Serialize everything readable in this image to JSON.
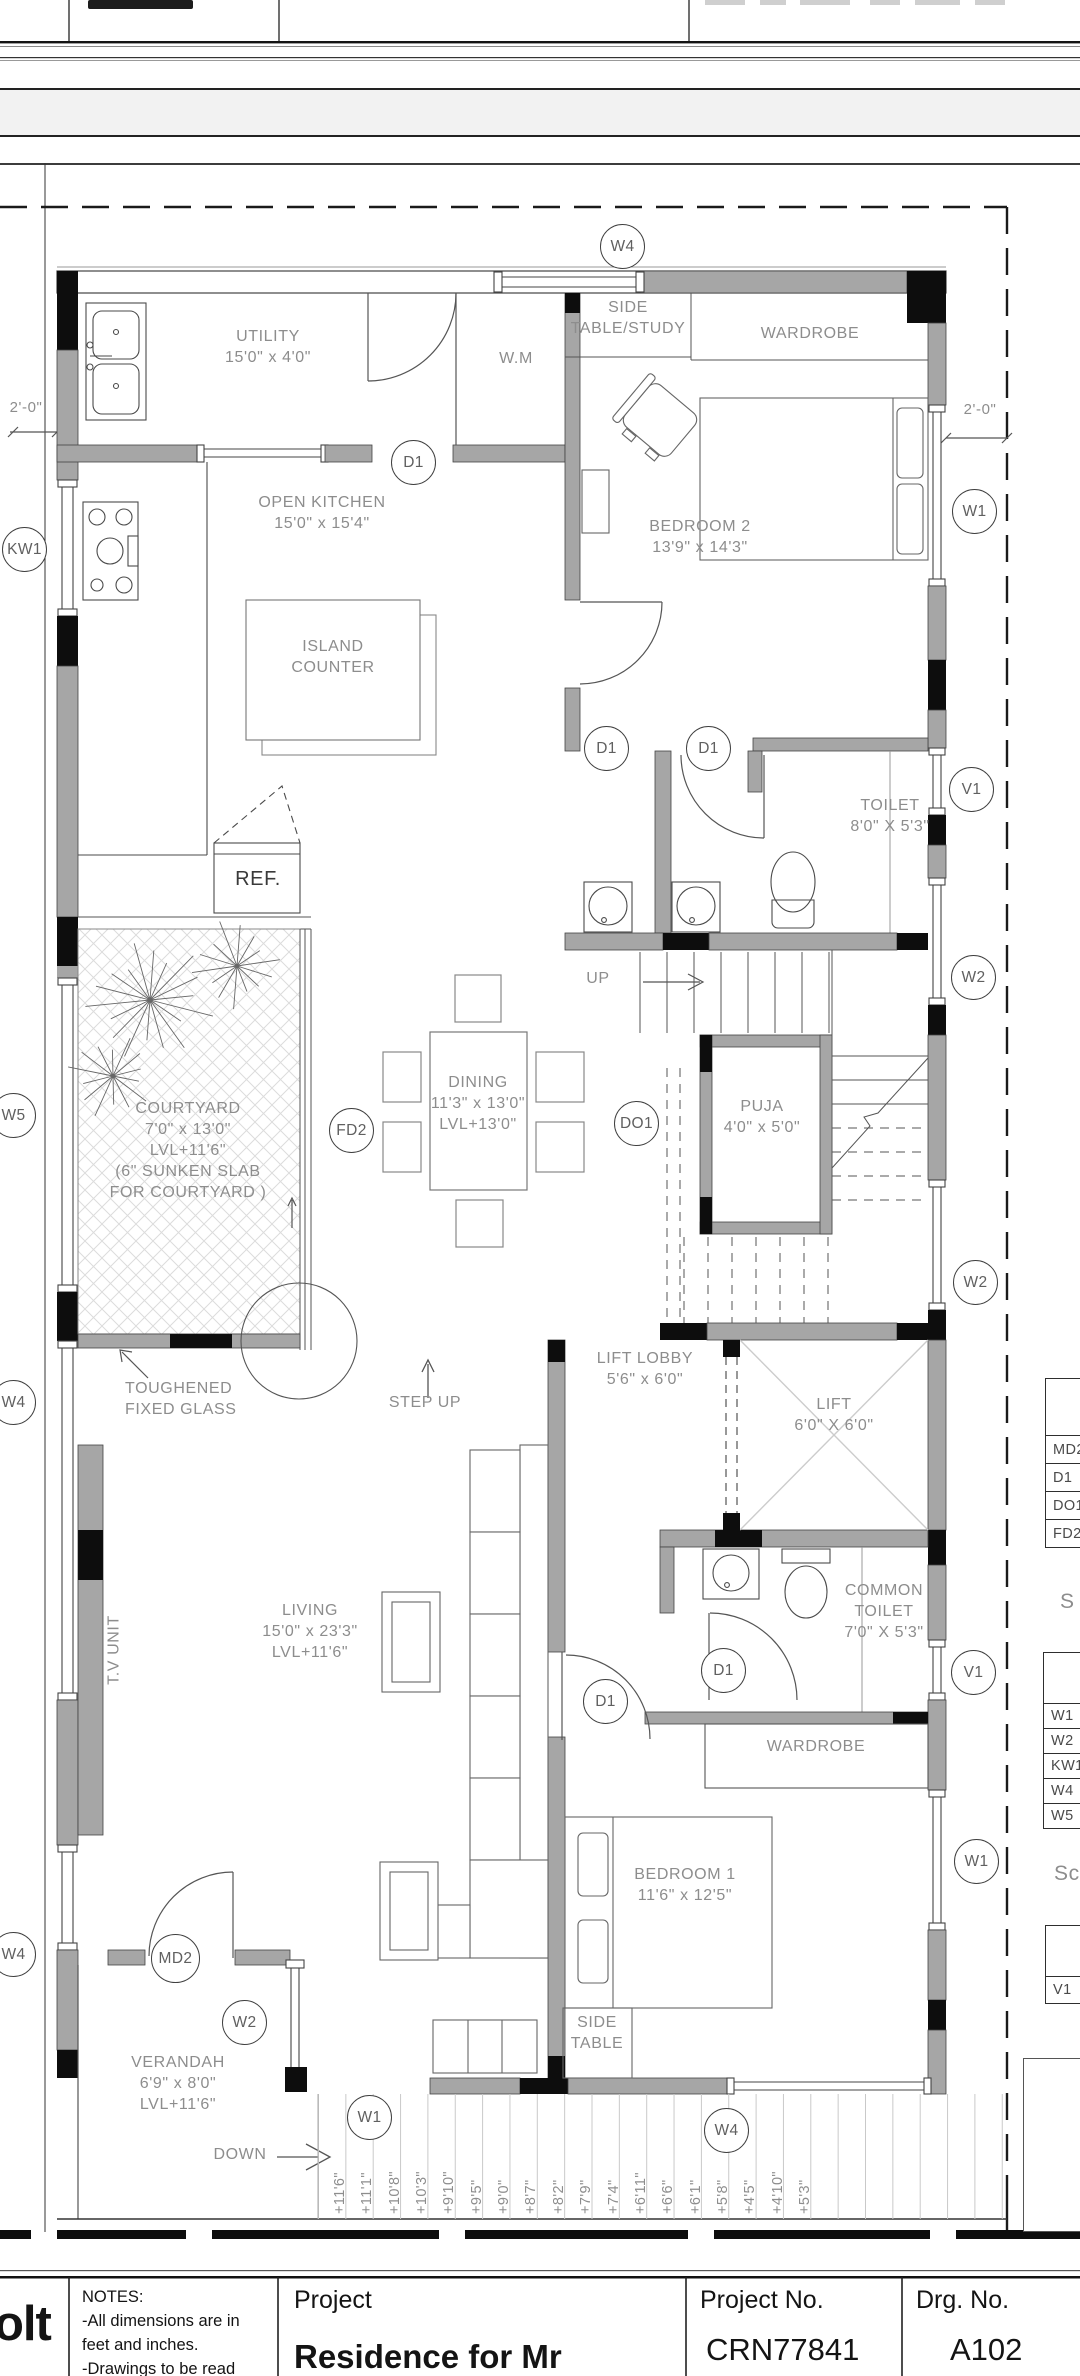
{
  "drawing": {
    "labels": [
      {
        "name": "label-utility",
        "x": 268,
        "y": 326,
        "lines": [
          "UTILITY",
          "15'0\" x 4'0\""
        ]
      },
      {
        "name": "label-wm",
        "x": 516,
        "y": 348,
        "lines": [
          "W.M"
        ]
      },
      {
        "name": "label-side-table-study",
        "x": 628,
        "y": 297,
        "lines": [
          "SIDE",
          "TABLE/STUDY"
        ]
      },
      {
        "name": "label-wardrobe-top",
        "x": 810,
        "y": 323,
        "lines": [
          "WARDROBE"
        ]
      },
      {
        "name": "label-open-kitchen",
        "x": 322,
        "y": 492,
        "lines": [
          "OPEN KITCHEN",
          "15'0\" x 15'4\""
        ]
      },
      {
        "name": "label-island-counter",
        "x": 333,
        "y": 636,
        "lines": [
          "ISLAND",
          "COUNTER"
        ]
      },
      {
        "name": "label-bedroom2",
        "x": 700,
        "y": 516,
        "lines": [
          "BEDROOM 2",
          "13'9\" x 14'3\""
        ]
      },
      {
        "name": "label-ref",
        "x": 258,
        "y": 866,
        "size": 20,
        "color": "#3a3a3a",
        "lines": [
          "REF."
        ]
      },
      {
        "name": "label-toilet2",
        "x": 890,
        "y": 795,
        "lines": [
          "TOILET",
          "8'0\" X 5'3\""
        ]
      },
      {
        "name": "label-up",
        "x": 598,
        "y": 968,
        "lines": [
          "UP"
        ]
      },
      {
        "name": "label-dining",
        "x": 478,
        "y": 1072,
        "lines": [
          "DINING",
          "11'3\" x 13'0\"",
          "LVL+13'0\""
        ]
      },
      {
        "name": "label-puja",
        "x": 762,
        "y": 1096,
        "lines": [
          "PUJA",
          "4'0\" x 5'0\""
        ]
      },
      {
        "name": "label-courtyard",
        "x": 188,
        "y": 1098,
        "lines": [
          "COURTYARD",
          "7'0\" x 13'0\"",
          "LVL+11'6\"",
          "(6\" SUNKEN SLAB",
          "FOR COURTYARD )"
        ]
      },
      {
        "name": "label-toughened-glass",
        "x": 125,
        "y": 1378,
        "align": "left",
        "lines": [
          "TOUGHENED",
          "FIXED GLASS"
        ]
      },
      {
        "name": "label-step-up",
        "x": 425,
        "y": 1392,
        "lines": [
          "STEP UP"
        ]
      },
      {
        "name": "label-lift-lobby",
        "x": 645,
        "y": 1348,
        "lines": [
          "LIFT LOBBY",
          "5'6\" x 6'0\""
        ]
      },
      {
        "name": "label-lift",
        "x": 834,
        "y": 1394,
        "lines": [
          "LIFT",
          "6'0\" X 6'0\""
        ]
      },
      {
        "name": "label-tv-unit",
        "x": 114,
        "y": 1650,
        "rotate": -90,
        "lines": [
          "T.V UNIT"
        ]
      },
      {
        "name": "label-living",
        "x": 310,
        "y": 1600,
        "lines": [
          "LIVING",
          "15'0\" x 23'3\"",
          "LVL+11'6\""
        ]
      },
      {
        "name": "label-common-toilet",
        "x": 884,
        "y": 1580,
        "lines": [
          "COMMON",
          "TOILET",
          "7'0\" X 5'3\""
        ]
      },
      {
        "name": "label-wardrobe-br1",
        "x": 816,
        "y": 1736,
        "lines": [
          "WARDROBE"
        ]
      },
      {
        "name": "label-bedroom1",
        "x": 685,
        "y": 1864,
        "lines": [
          "BEDROOM 1",
          "11'6\" x 12'5\""
        ]
      },
      {
        "name": "label-side-table",
        "x": 597,
        "y": 2012,
        "lines": [
          "SIDE",
          "TABLE"
        ]
      },
      {
        "name": "label-verandah",
        "x": 178,
        "y": 2052,
        "lines": [
          "VERANDAH",
          "6'9\" x 8'0\"",
          "LVL+11'6\""
        ]
      },
      {
        "name": "label-down",
        "x": 240,
        "y": 2144,
        "lines": [
          "DOWN"
        ]
      },
      {
        "name": "dim-left",
        "x": 26,
        "y": 398,
        "size": 15,
        "lines": [
          "2'-0\""
        ]
      },
      {
        "name": "dim-right",
        "x": 980,
        "y": 400,
        "size": 15,
        "lines": [
          "2'-0\""
        ]
      },
      {
        "name": "schedule-heading-1",
        "x": 1060,
        "y": 1588,
        "align": "left",
        "size": 21,
        "lines": [
          "S"
        ]
      },
      {
        "name": "schedule-heading-2",
        "x": 1054,
        "y": 1860,
        "align": "left",
        "size": 21,
        "lines": [
          "Sc"
        ]
      },
      {
        "name": "area-line-built-up",
        "x": 1030,
        "y": 2086,
        "align": "left",
        "size": 15.5,
        "lines": [
          "Built-u"
        ]
      },
      {
        "name": "area-line-courtyard",
        "x": 1026,
        "y": 2126,
        "align": "left",
        "size": 15.5,
        "lines": [
          "Court"
        ]
      },
      {
        "name": "area-line-verandah",
        "x": 1031,
        "y": 2151,
        "align": "left",
        "size": 15.5,
        "lines": [
          "Vera"
        ]
      },
      {
        "name": "area-line-utility",
        "x": 1039,
        "y": 2176,
        "align": "left",
        "size": 15.5,
        "lines": [
          "Util"
        ]
      }
    ],
    "markers": [
      {
        "label": "W4",
        "x": 623,
        "y": 247
      },
      {
        "label": "KW1",
        "x": 25,
        "y": 550
      },
      {
        "label": "D1",
        "x": 414,
        "y": 463
      },
      {
        "label": "W1",
        "x": 975,
        "y": 512
      },
      {
        "label": "D1",
        "x": 607,
        "y": 749
      },
      {
        "label": "D1",
        "x": 709,
        "y": 749
      },
      {
        "label": "V1",
        "x": 972,
        "y": 790
      },
      {
        "label": "W2",
        "x": 974,
        "y": 978
      },
      {
        "label": "W5",
        "x": 14,
        "y": 1116
      },
      {
        "label": "FD2",
        "x": 352,
        "y": 1131
      },
      {
        "label": "DO1",
        "x": 637,
        "y": 1124
      },
      {
        "label": "W2",
        "x": 976,
        "y": 1283
      },
      {
        "label": "W4",
        "x": 14,
        "y": 1403
      },
      {
        "label": "D1",
        "x": 724,
        "y": 1671
      },
      {
        "label": "V1",
        "x": 974,
        "y": 1673
      },
      {
        "label": "D1",
        "x": 606,
        "y": 1702
      },
      {
        "label": "W1",
        "x": 977,
        "y": 1862
      },
      {
        "label": "W4",
        "x": 14,
        "y": 1955
      },
      {
        "label": "MD2",
        "x": 176,
        "y": 1959,
        "r": 25
      },
      {
        "label": "W2",
        "x": 245,
        "y": 2023
      },
      {
        "label": "W1",
        "x": 370,
        "y": 2118
      },
      {
        "label": "W4",
        "x": 727,
        "y": 2131
      }
    ],
    "steps": {
      "x0": 332,
      "dx": 27.35,
      "y": 2214,
      "labels": [
        "+11'6\"",
        "+11'1\"",
        "+10'8\"",
        "+10'3\"",
        "+9'10\"",
        "+9'5\"",
        "+9'0\"",
        "+8'7\"",
        "+8'2\"",
        "+7'9\"",
        "+7'4\"",
        "+6'11\"",
        "+6'6\"",
        "+6'1\"",
        "+5'8\"",
        "+4'5\"",
        "+4'10\"",
        "+5'3\""
      ]
    },
    "schedules": {
      "door": {
        "x": 1045,
        "y": 1378,
        "width": 60,
        "header_h": 56,
        "row_h": 28,
        "rows": [
          "MD2",
          "D1",
          "DO1",
          "FD2"
        ]
      },
      "window": {
        "x": 1043,
        "y": 1652,
        "width": 62,
        "header_h": 50,
        "row_h": 25,
        "rows": [
          "W1",
          "W2",
          "KW1",
          "W4",
          "W5"
        ]
      },
      "vent": {
        "x": 1045,
        "y": 1925,
        "width": 60,
        "header_h": 50,
        "row_h": 27,
        "rows": [
          "V1"
        ]
      }
    }
  },
  "title_block": {
    "logo": "olt",
    "notes_title": "NOTES:",
    "notes_line1": "-All dimensions are in",
    "notes_line2": "feet and inches.",
    "notes_line3": "-Drawings to be read",
    "project_label": "Project",
    "project_name": "Residence for Mr",
    "project_no_label": "Project No.",
    "project_no": "CRN77841",
    "drg_no_label": "Drg. No.",
    "drg_no": "A102"
  }
}
